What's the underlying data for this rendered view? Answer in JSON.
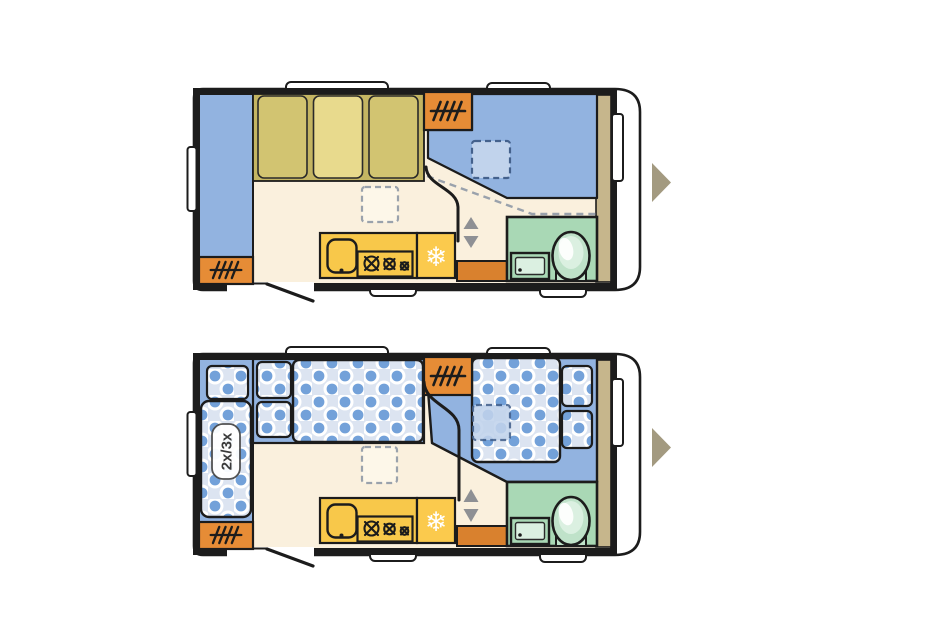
{
  "canvas": {
    "width": 951,
    "height": 630,
    "background": "#ffffff"
  },
  "colors": {
    "wall": "#1c1c1c",
    "body_fill": "#ffffff",
    "floor": "#faf0dd",
    "seat_blue": "#92b3e0",
    "mattress_base": "#dce4f1",
    "mattress_dot": "#73a1d9",
    "wardrobe_base": "#c4b562",
    "wardrobe_panel": "#d2c471",
    "wardrobe_panel_light": "#e8da8d",
    "heater_orange": "#e68c36",
    "cabinet_orange": "#d9812e",
    "kitchen_yellow": "#f8c84a",
    "fridge_yellow": "#fbca4d",
    "bath_green": "#a9d8b5",
    "toilet_green": "#bfe2c9",
    "bath_fixture_light": "#dbf0e1",
    "rear_wardrobe_tan": "#c6b68c",
    "entry_pointer_taupe": "#a39a80",
    "slide_arrow_grey": "#8e9094",
    "dash_grey": "#9aa2ac",
    "skylight_blue": "#c1d3ec",
    "skylight_blue_dash": "#44618c",
    "skylight_cream": "#fdf7e9",
    "label_text": "#3a3a3a"
  },
  "icons": {
    "fridge_snowflake_glyph": "❄",
    "names": [
      "heater-grille-icon",
      "fridge-snowflake-icon",
      "stove-burner-icon",
      "kitchen-sink-icon",
      "bathroom-sink-icon",
      "toilet-icon",
      "roof-vent",
      "window-bump",
      "entry-door-swing",
      "slide-door-arrow-up-icon",
      "slide-door-arrow-down-icon",
      "entry-side-pointer-icon"
    ],
    "slide_arrow_up": "▲",
    "slide_arrow_down": "▼",
    "entry_pointer": "▶"
  },
  "floorplans": {
    "day": {
      "id": "day-floorplan"
    },
    "night": {
      "id": "night-floorplan",
      "bunk_label": "2x/3x"
    }
  }
}
